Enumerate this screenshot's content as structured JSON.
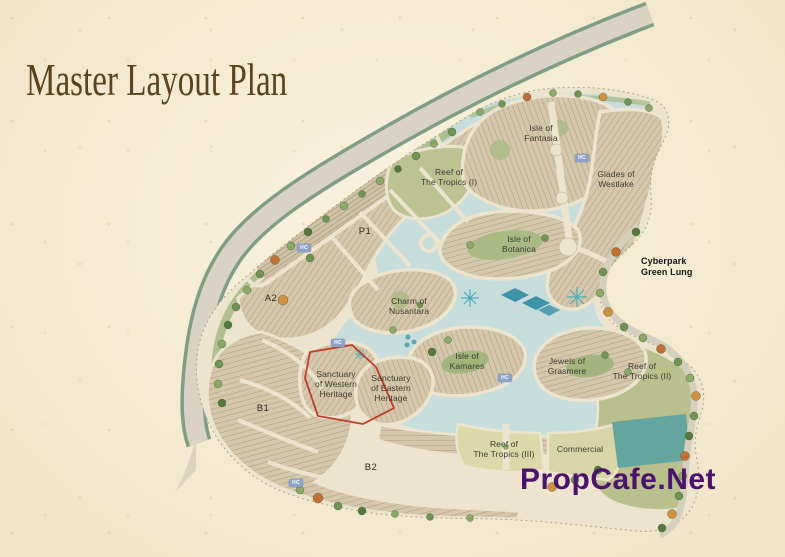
{
  "page": {
    "title": "Master Layout Plan",
    "watermark": "PropCafe.Net"
  },
  "map": {
    "hc_label": "HC",
    "labels": [
      {
        "name": "isle-of-fantasia",
        "text": "Isle of\nFantasia"
      },
      {
        "name": "reef-of-the-tropics-i",
        "text": "Reef of\nThe Tropics (I)"
      },
      {
        "name": "glades-of-westlake",
        "text": "Glades of\nWestlake"
      },
      {
        "name": "isle-of-botanica",
        "text": "Isle of\nBotanica"
      },
      {
        "name": "cyberpark-green-lung",
        "text": "Cyberpark\nGreen Lung"
      },
      {
        "name": "charm-of-nusantara",
        "text": "Charm of\nNusantara"
      },
      {
        "name": "isle-of-kamares",
        "text": "Isle of\nKamares"
      },
      {
        "name": "jewels-of-grasmere",
        "text": "Jewels of\nGrasmere"
      },
      {
        "name": "sanctuary-of-western-heritage",
        "text": "Sanctuary\nof Western\nHeritage"
      },
      {
        "name": "sanctuary-of-eastern-heritage",
        "text": "Sanctuary\nof Eastern\nHeritage"
      },
      {
        "name": "reef-of-the-tropics-ii",
        "text": "Reef of\nThe Tropics (II)"
      },
      {
        "name": "reef-of-the-tropics-iii",
        "text": "Reef of\nThe Tropics (III)"
      },
      {
        "name": "commercial",
        "text": "Commercial"
      },
      {
        "name": "zone-p1",
        "text": "P1"
      },
      {
        "name": "zone-a2",
        "text": "A2"
      },
      {
        "name": "zone-b1",
        "text": "B1"
      },
      {
        "name": "zone-b2",
        "text": "B2"
      }
    ],
    "colors": {
      "parchment": "#f4ead1",
      "title_brown": "#5a431d",
      "watermark_purple": "#4b136e",
      "lake_blue": "#c6dddb",
      "highlight_red": "#c23b28",
      "label_dark": "#3c3c31"
    }
  }
}
